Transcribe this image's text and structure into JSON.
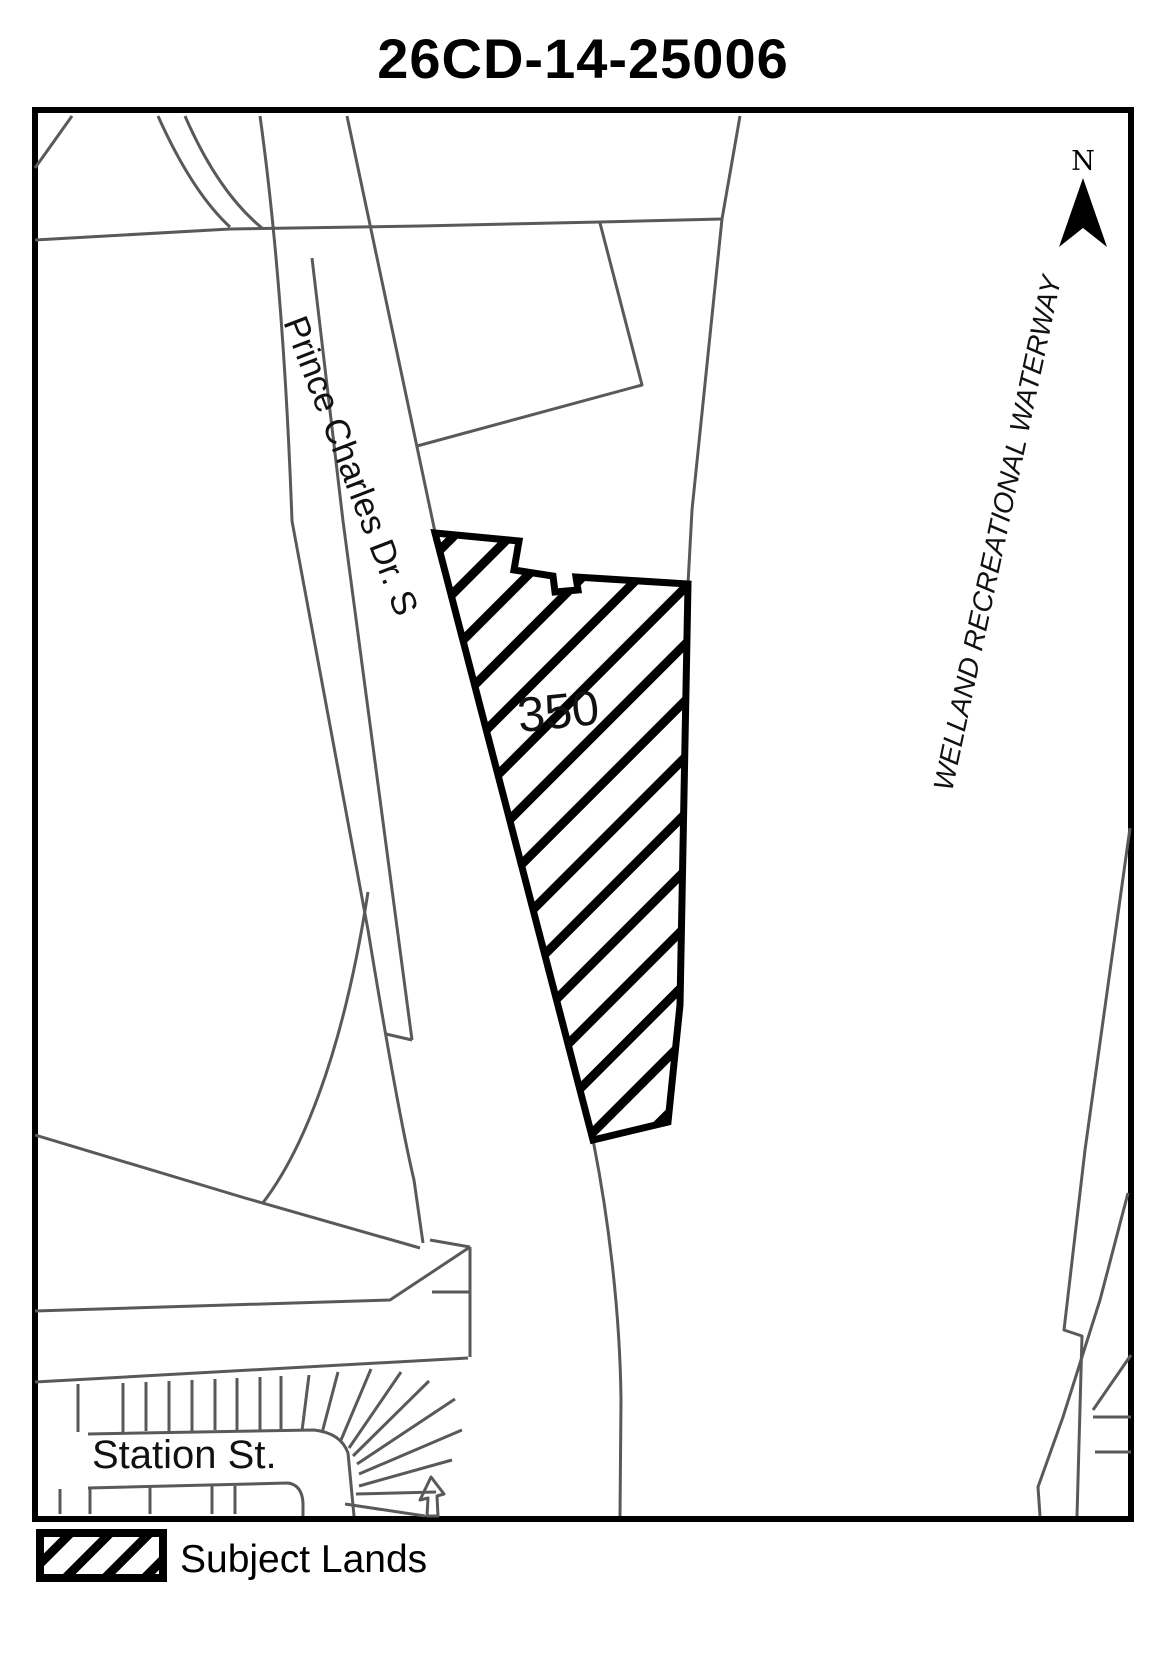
{
  "title": "26CD-14-25006",
  "map": {
    "parcel_label": "350",
    "street_prince_charles": "Prince Charles Dr. S",
    "street_station": "Station St.",
    "waterway_label": "WELLAND RECREATIONAL WATERWAY",
    "north_label": "N"
  },
  "legend": {
    "subject_lands_label": "Subject Lands"
  },
  "colors": {
    "line_gray": "#595959",
    "outline_black": "#000000",
    "background": "#ffffff"
  }
}
